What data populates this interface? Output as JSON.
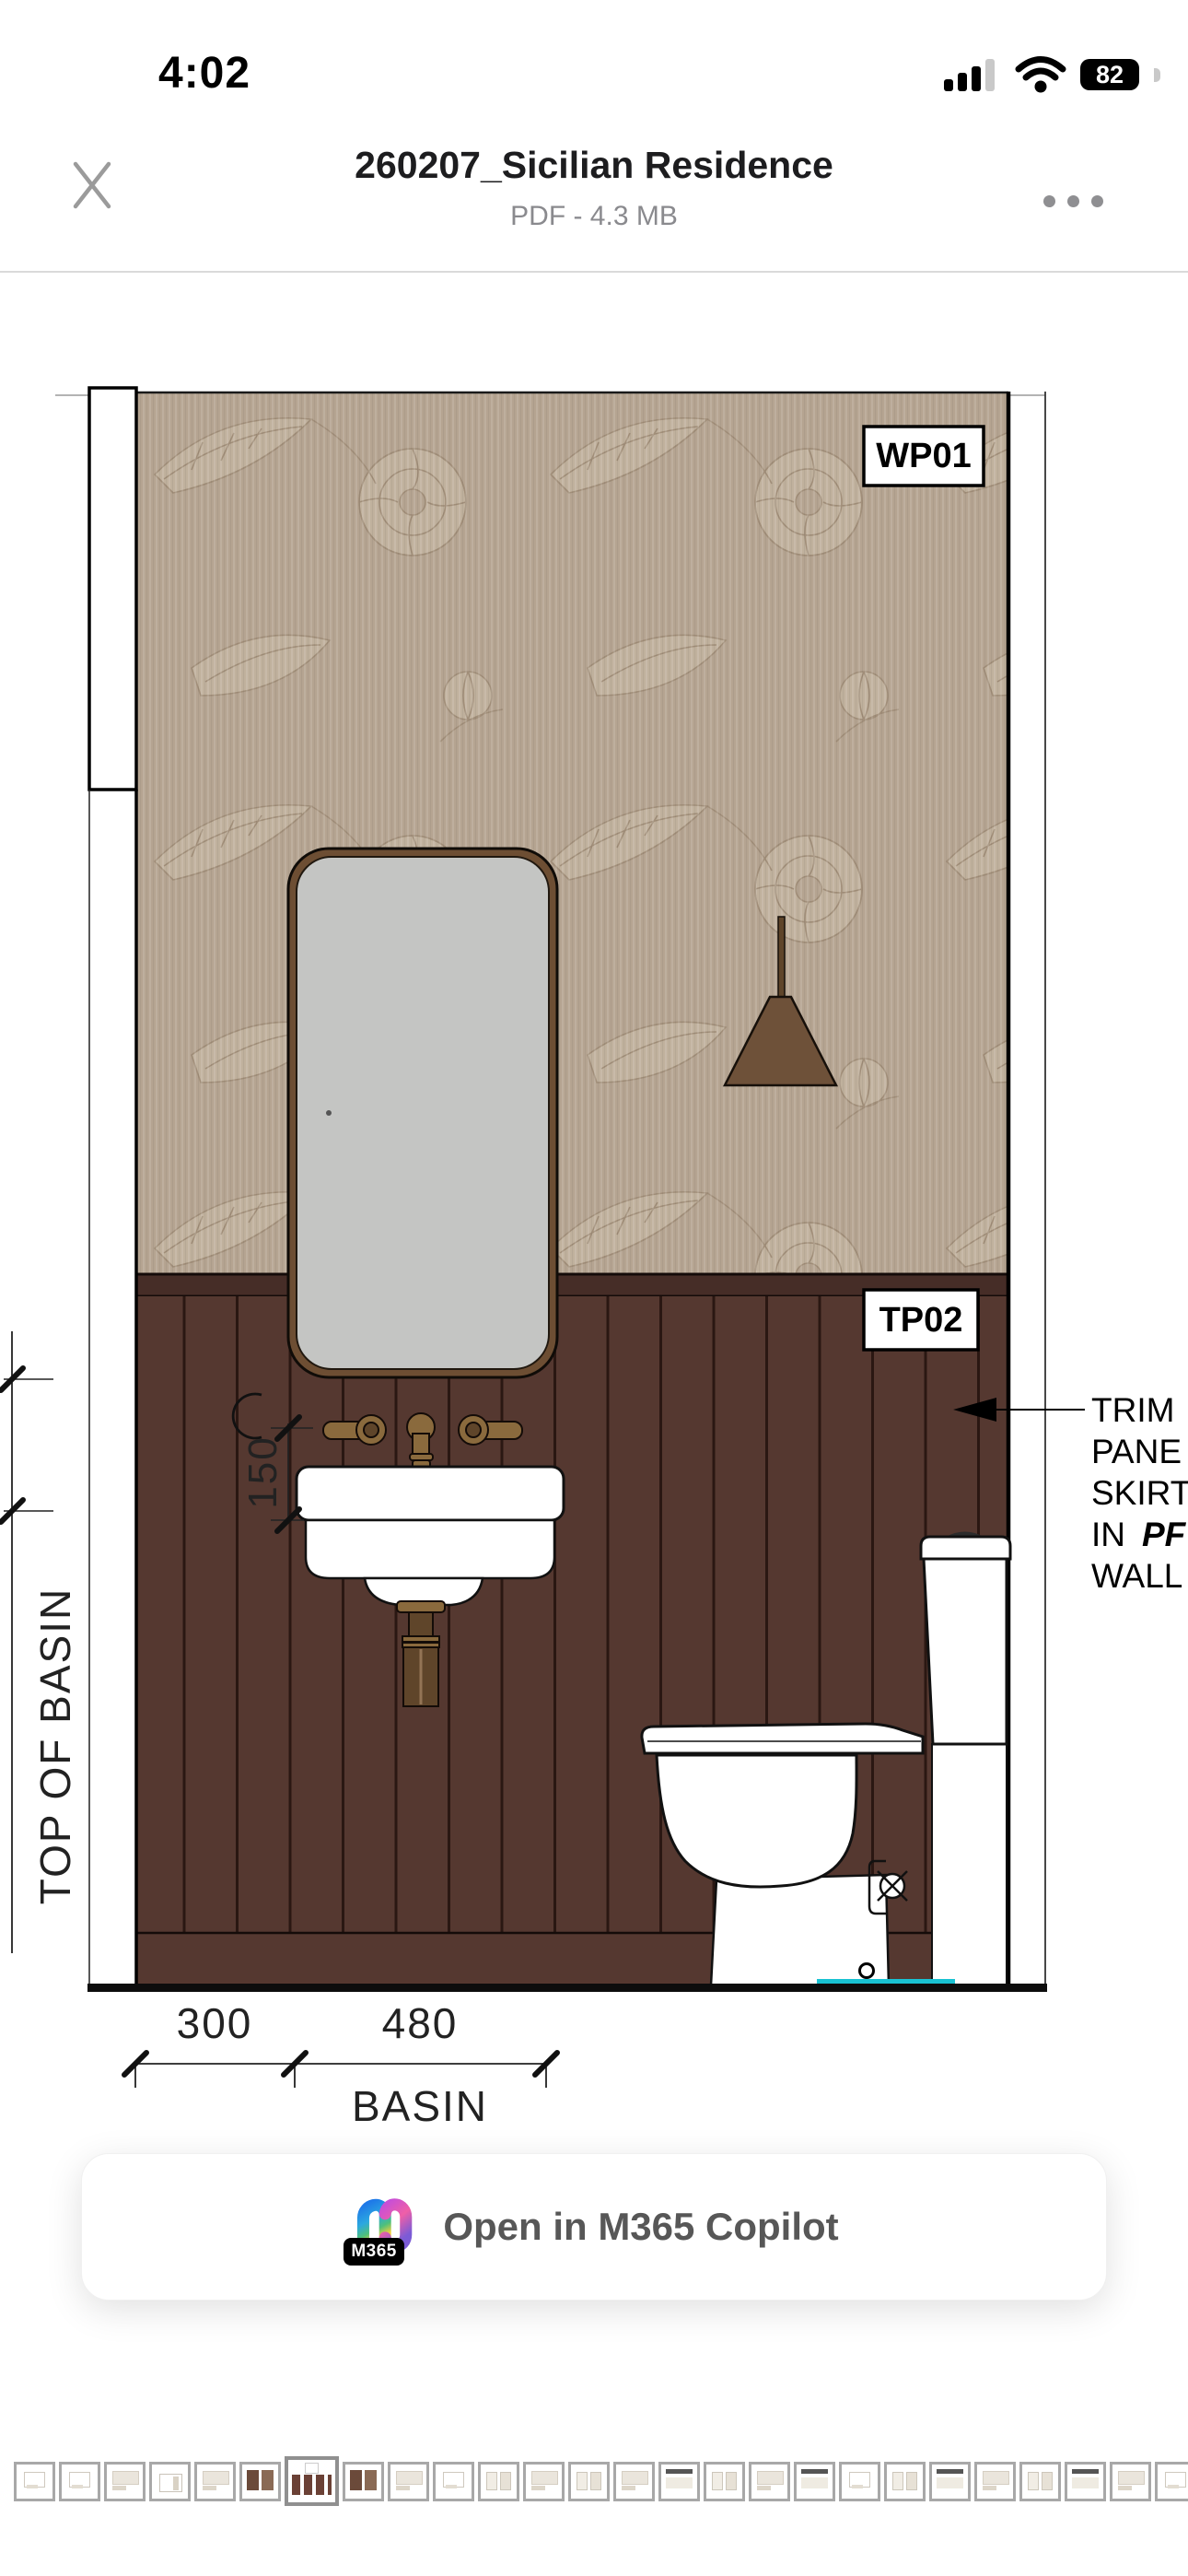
{
  "colors": {
    "wallpaper": "#b5a491",
    "wpLight": "#c9bca7",
    "wpDark": "#8f7c66",
    "panel": "#553830",
    "rail": "#462d27",
    "panelLine": "#2a1712",
    "brass": "#8a6a3d",
    "brassDark": "#5f452a",
    "pendant": "#6e5139",
    "mirrorFrame": "#6d4e33",
    "mirrorGlass": "#c4c5c3",
    "teal": "#19c2d3",
    "ink": "#1d1d1f"
  },
  "status_bar": {
    "time": "4:02",
    "battery_percent": "82"
  },
  "header": {
    "title": "260207_Sicilian Residence",
    "subtitle": "PDF - 4.3 MB"
  },
  "drawing": {
    "finish_tags": {
      "wallpaper": "WP01",
      "timber_panel": "TP02"
    },
    "dimensions": {
      "offset": "300",
      "basin_width": "480",
      "basin_caption": "BASIN",
      "tap_offset": "150",
      "level_caption": "TOP OF BASIN"
    },
    "annotation": {
      "line1": "TRIM",
      "line2": "PANE",
      "line3": "SKIRT",
      "line4_regular": "IN",
      "line4_emphasis": "PF",
      "line5": "WALL"
    }
  },
  "copilot_button": {
    "label": "Open in M365 Copilot",
    "badge": "M365"
  },
  "thumbnails": {
    "selected_index": 6,
    "items": [
      "m1",
      "m1",
      "m2",
      "m4",
      "m2",
      "m5",
      "sel",
      "m5",
      "m2",
      "m1",
      "m3",
      "m2",
      "m3",
      "m2",
      "m6",
      "m3",
      "m2",
      "m6",
      "m1",
      "m3",
      "m6",
      "m2",
      "m3",
      "m6",
      "m2",
      "m1",
      "m3"
    ]
  }
}
